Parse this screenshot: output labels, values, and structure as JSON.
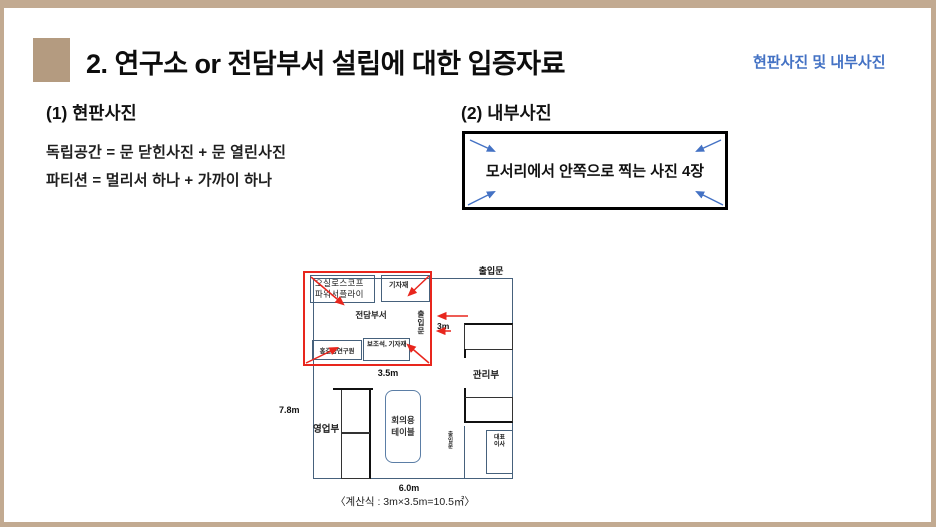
{
  "slide": {
    "title": "2. 연구소 or 전담부서 설립에 대한 입증자료",
    "corner_note": "현판사진 및 내부사진"
  },
  "signboard_section": {
    "heading": "(1) 현판사진",
    "rule_independent_space": "독립공간 = 문 닫힌사진 + 문 열린사진",
    "rule_partition": "파티션 = 멀리서 하나 + 가까이 하나"
  },
  "interior_section": {
    "heading": "(2) 내부사진",
    "box_note": "모서리에서 안쪽으로 찍는 사진 4장"
  },
  "floorplan": {
    "entrance_top_label": "출입문",
    "dedicated_room": {
      "name": "전담부서",
      "entrance_label": "출입문",
      "equipment_box_left": "오실로스코프 파워서플라이",
      "equipment_box_right": "기자재",
      "researcher_box": "홍길동연구원",
      "assistant_box": "보조석, 기자재",
      "width_label": "3.5m",
      "depth_label": "3m"
    },
    "management_label": "관리부",
    "sales_label": "영업부",
    "ceo_label": "대표이사",
    "meeting_table_label": "회의용 테이블",
    "inner_door_label": "출입문",
    "office_height_label": "7.8m",
    "office_width_label": "6.0m",
    "formula_caption": "〈계산식 : 3m×3.5m=10.5㎡〉"
  },
  "colors": {
    "frame_tan": "#c2aa91",
    "bullet_tan": "#b49b80",
    "accent_blue": "#4472c4",
    "highlight_red": "#e8261d",
    "wall_blue_gray": "#46617c"
  }
}
